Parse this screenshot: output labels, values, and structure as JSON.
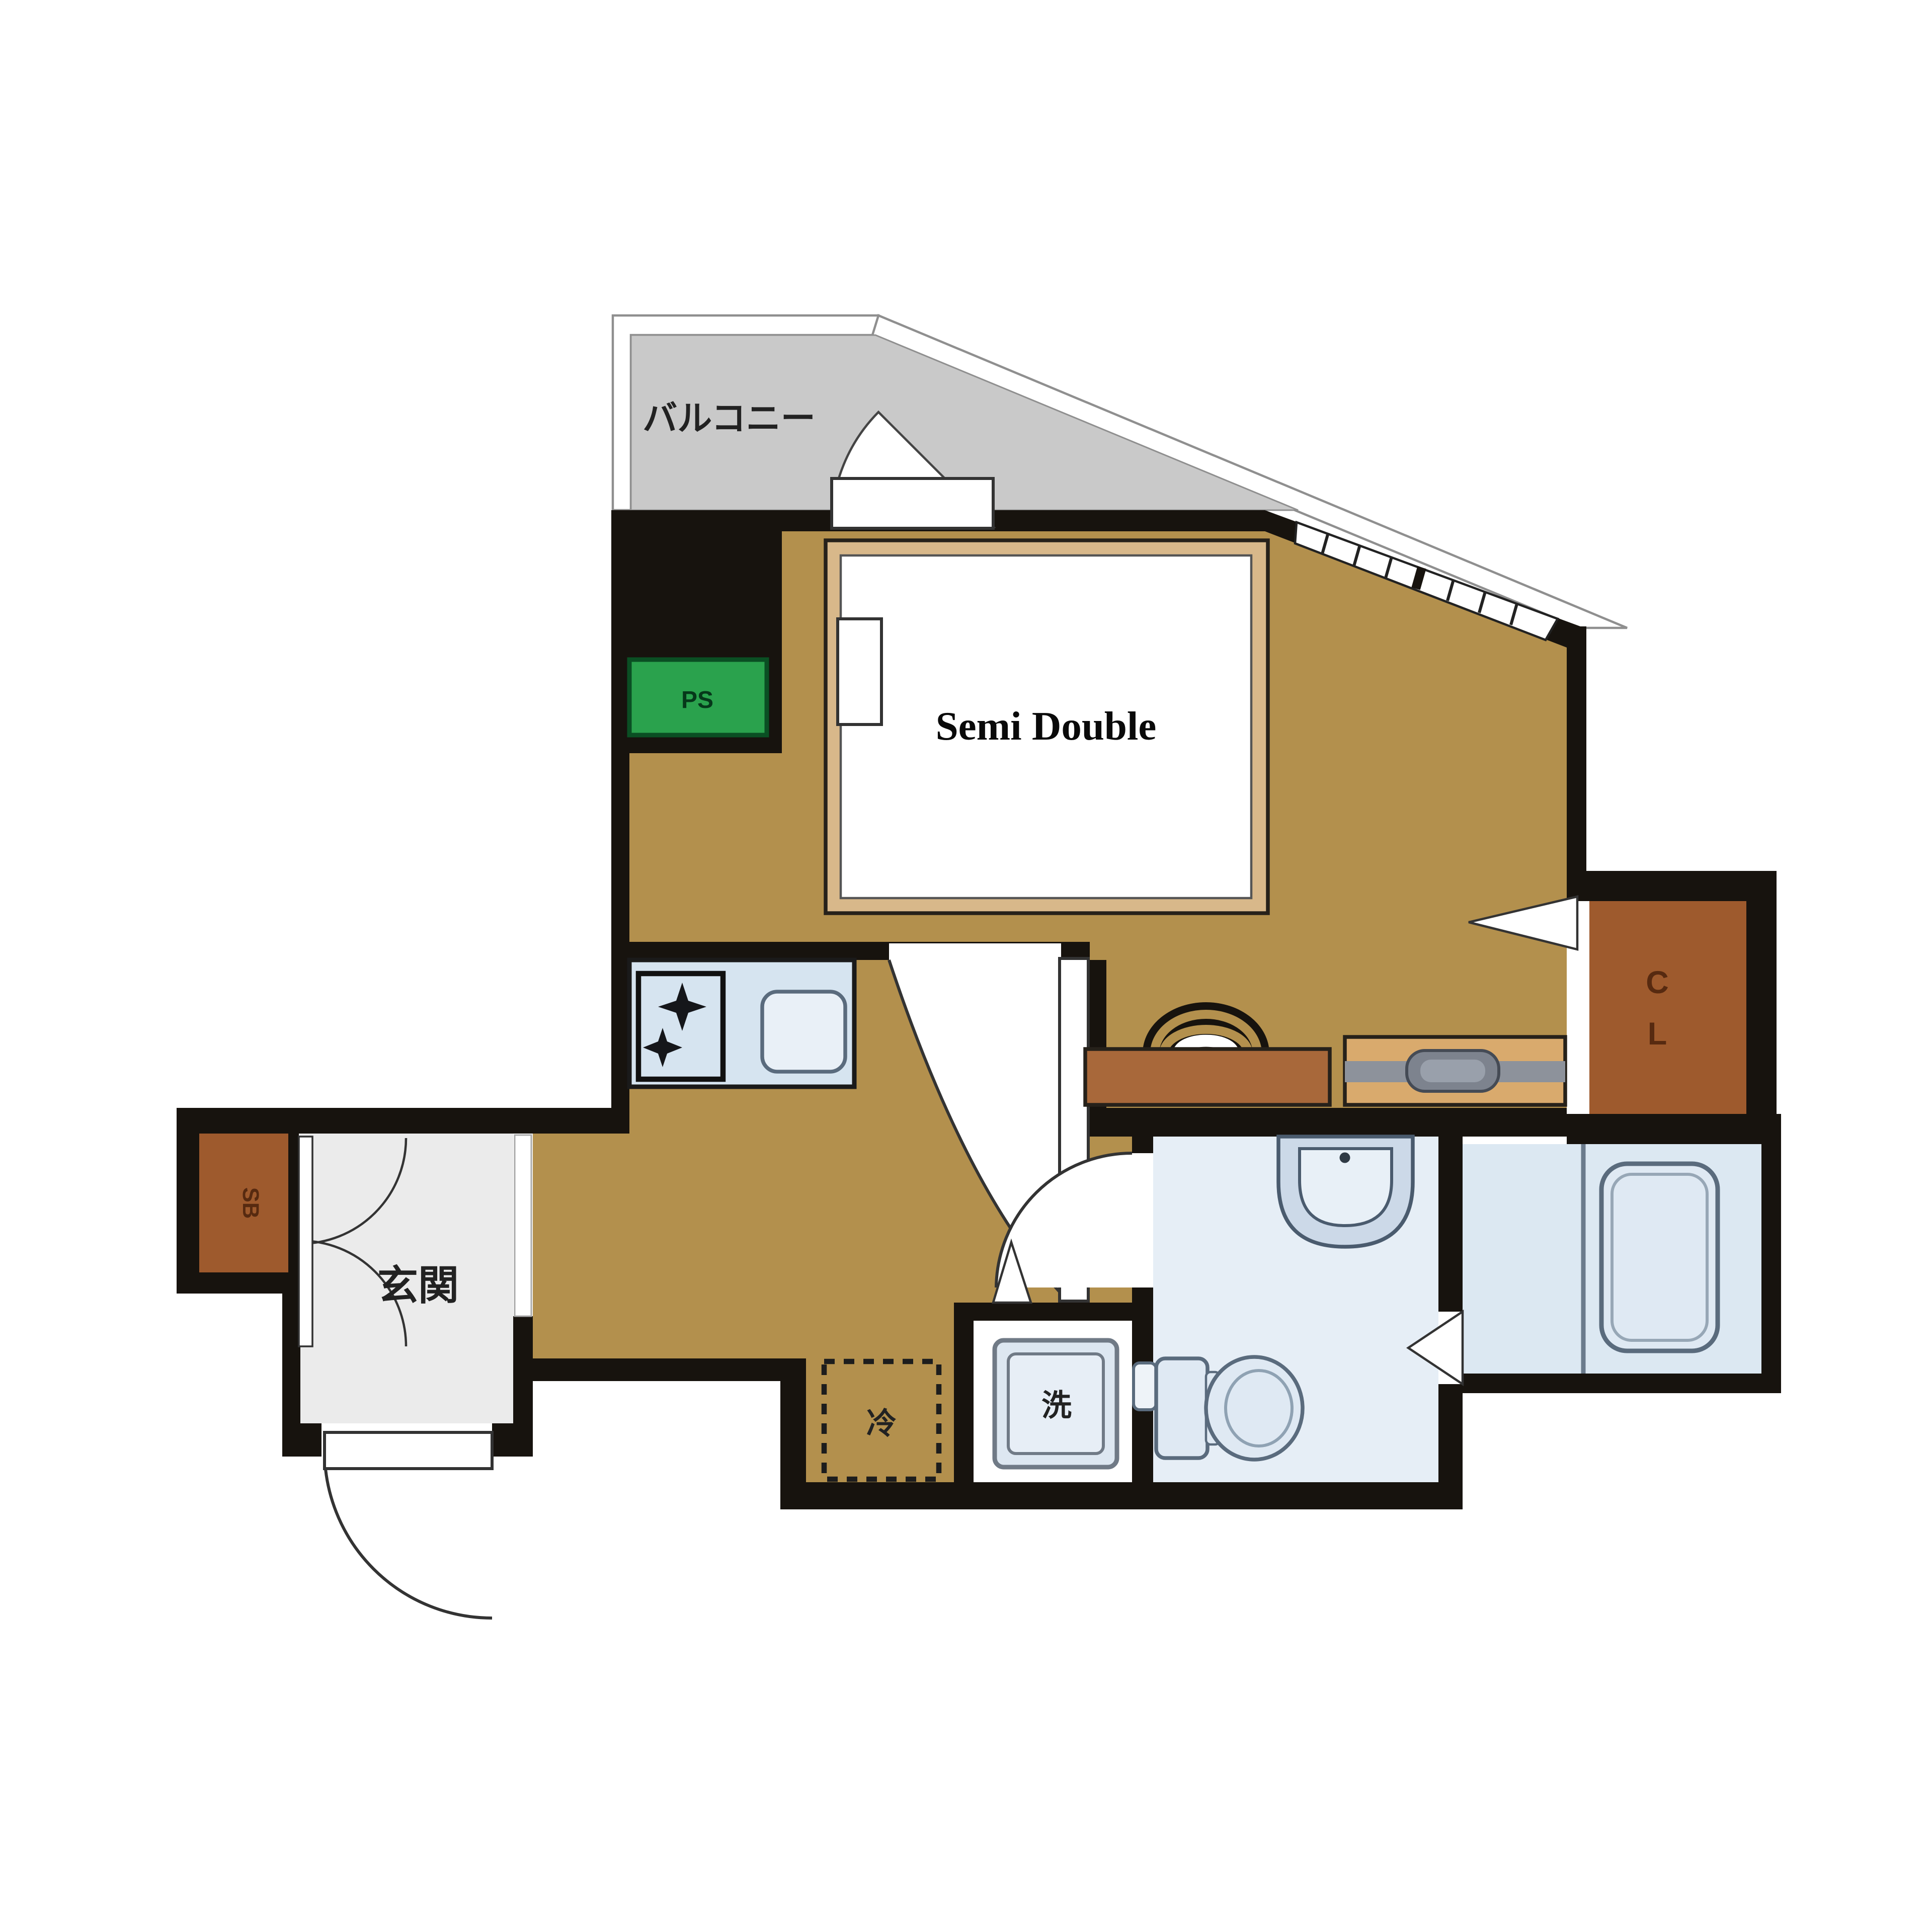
{
  "plan": {
    "type": "apartment-floorplan",
    "labels": {
      "balcony": "バルコニー",
      "bed": "Semi Double",
      "ps": "PS",
      "cl_c": "C",
      "cl_l": "L",
      "sb": "SB",
      "genkan": "玄関",
      "fridge": "冷",
      "washer": "洗"
    },
    "colors": {
      "wall": "#17130e",
      "floor_main": "#b3904d",
      "balcony": "#c9c9c9",
      "ps_green": "#2aa24d",
      "closet_brown": "#9e5a2d",
      "counter": "#d6e4f0",
      "fixture_blue": "#dfe9f3",
      "bath_floor": "#dce8f2",
      "lav_floor": "#e6eef6",
      "genkan_floor": "#ebebeb",
      "bed_frame": "#d8b88a",
      "desk": "#a8683a",
      "dresser": "#d9aa6d"
    }
  }
}
